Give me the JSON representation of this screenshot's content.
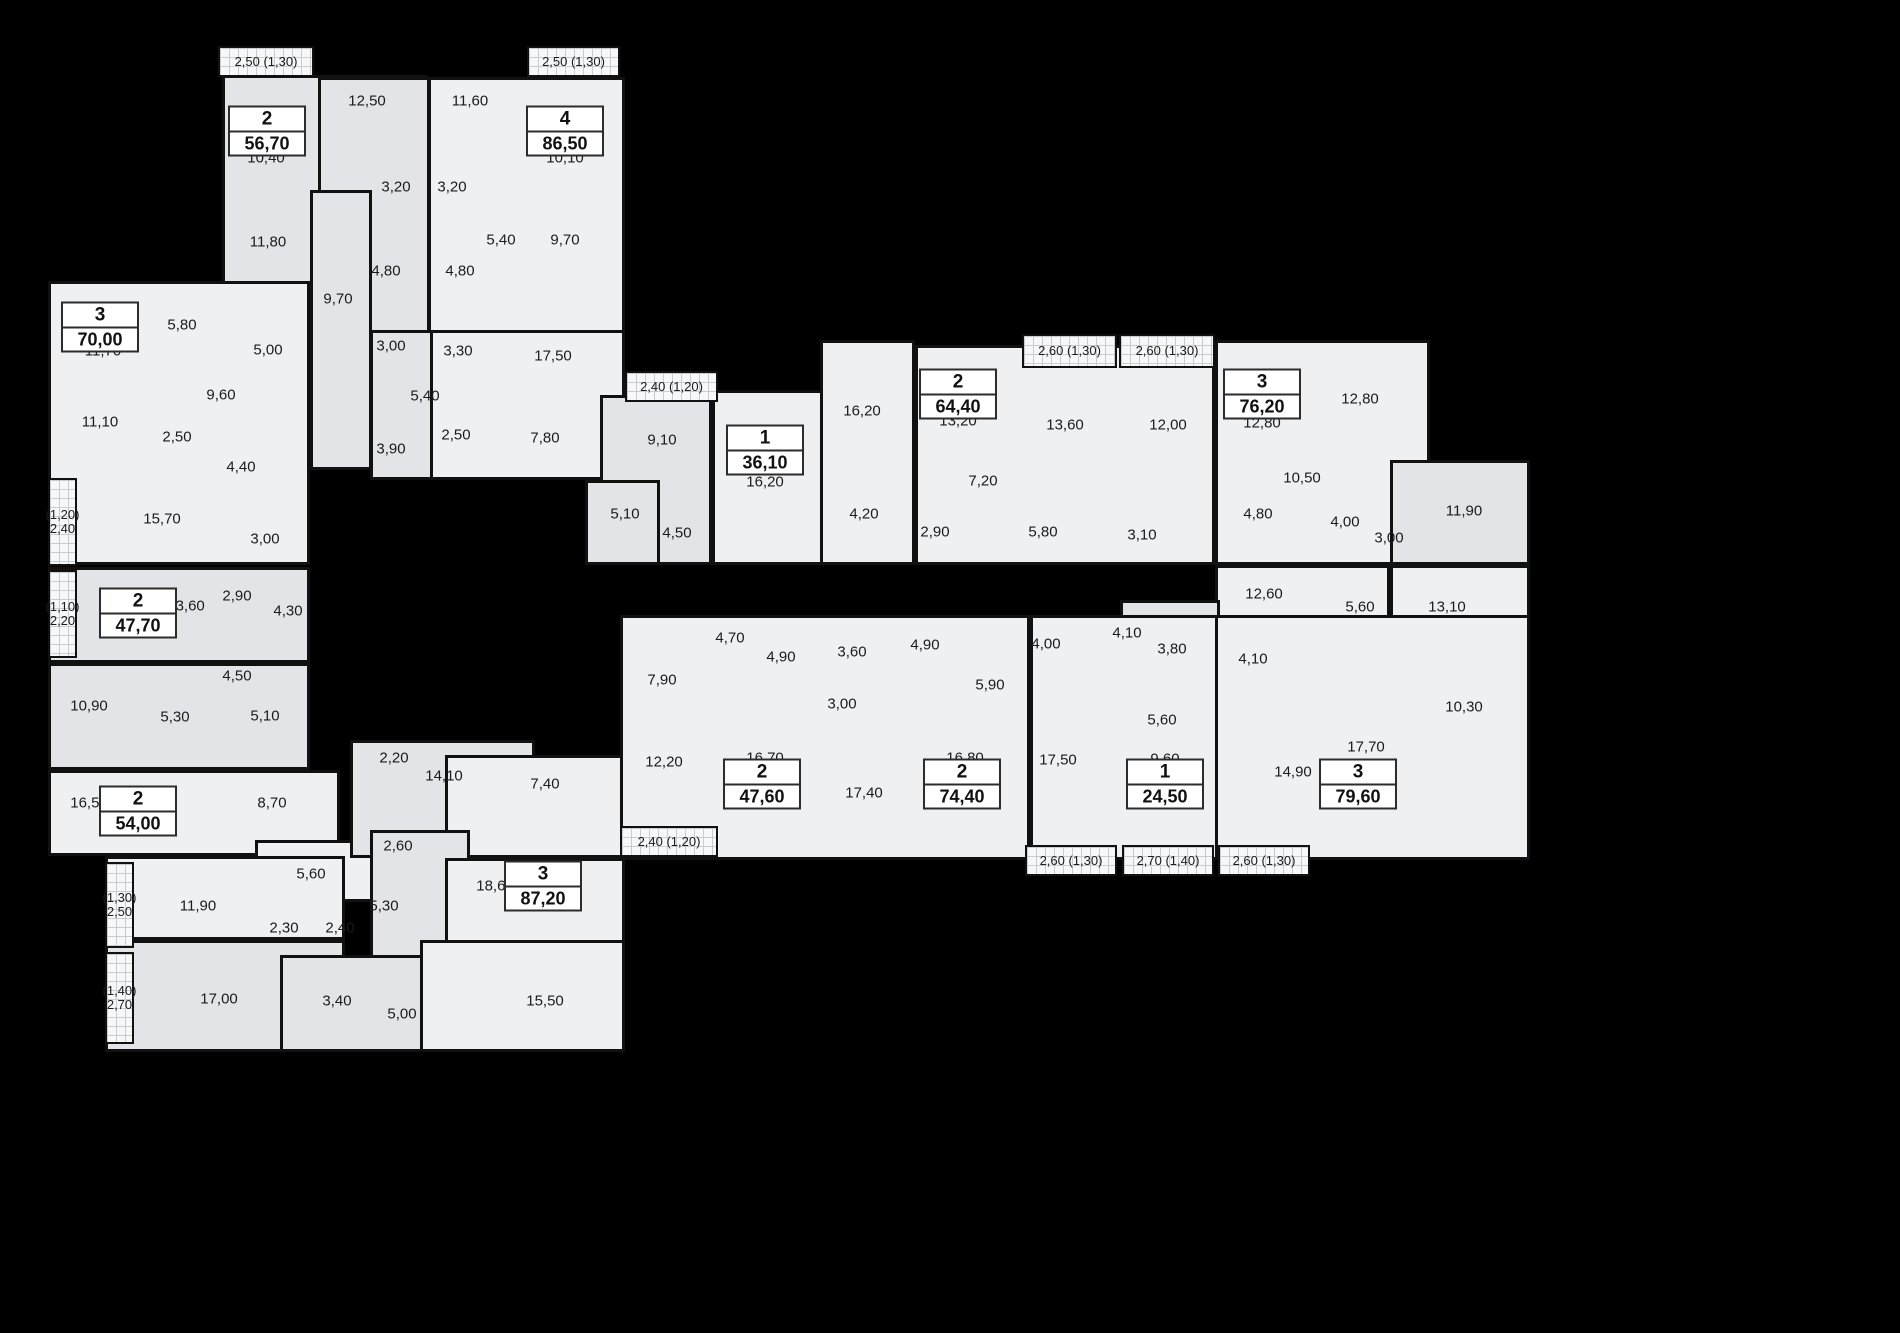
{
  "colors": {
    "background": "#000000",
    "room_light": "#eef0f2",
    "room_mid": "#e2e4e7",
    "wall": "#111111",
    "text": "#1b1b1b",
    "balcony_grid": "#c9ccd0"
  },
  "units": [
    {
      "rooms": "2",
      "area": "56,70",
      "x": 267,
      "y": 131
    },
    {
      "rooms": "4",
      "area": "86,50",
      "x": 565,
      "y": 131
    },
    {
      "rooms": "3",
      "area": "70,00",
      "x": 100,
      "y": 327
    },
    {
      "rooms": "2",
      "area": "47,70",
      "x": 138,
      "y": 613
    },
    {
      "rooms": "2",
      "area": "54,00",
      "x": 138,
      "y": 811
    },
    {
      "rooms": "3",
      "area": "87,20",
      "x": 543,
      "y": 886
    },
    {
      "rooms": "1",
      "area": "36,10",
      "x": 765,
      "y": 450
    },
    {
      "rooms": "2",
      "area": "64,40",
      "x": 958,
      "y": 394
    },
    {
      "rooms": "3",
      "area": "76,20",
      "x": 1262,
      "y": 394
    },
    {
      "rooms": "2",
      "area": "47,60",
      "x": 762,
      "y": 784
    },
    {
      "rooms": "2",
      "area": "74,40",
      "x": 962,
      "y": 784
    },
    {
      "rooms": "1",
      "area": "24,50",
      "x": 1165,
      "y": 784
    },
    {
      "rooms": "3",
      "area": "79,60",
      "x": 1358,
      "y": 784
    }
  ],
  "room_labels": [
    {
      "t": "12,50",
      "x": 367,
      "y": 101
    },
    {
      "t": "11,60",
      "x": 470,
      "y": 101
    },
    {
      "t": "10,40",
      "x": 266,
      "y": 158
    },
    {
      "t": "10,10",
      "x": 565,
      "y": 158
    },
    {
      "t": "3,20",
      "x": 396,
      "y": 187
    },
    {
      "t": "3,20",
      "x": 452,
      "y": 187
    },
    {
      "t": "11,80",
      "x": 268,
      "y": 242
    },
    {
      "t": "5,40",
      "x": 501,
      "y": 240
    },
    {
      "t": "9,70",
      "x": 565,
      "y": 240
    },
    {
      "t": "4,80",
      "x": 386,
      "y": 271
    },
    {
      "t": "4,80",
      "x": 460,
      "y": 271
    },
    {
      "t": "9,70",
      "x": 338,
      "y": 299
    },
    {
      "t": "3,00",
      "x": 391,
      "y": 346
    },
    {
      "t": "3,30",
      "x": 458,
      "y": 351
    },
    {
      "t": "17,50",
      "x": 553,
      "y": 356
    },
    {
      "t": "5,40",
      "x": 425,
      "y": 396
    },
    {
      "t": "2,50",
      "x": 456,
      "y": 435
    },
    {
      "t": "3,90",
      "x": 391,
      "y": 449
    },
    {
      "t": "7,80",
      "x": 545,
      "y": 438
    },
    {
      "t": "5,80",
      "x": 182,
      "y": 325
    },
    {
      "t": "11,70",
      "x": 103,
      "y": 351
    },
    {
      "t": "5,00",
      "x": 268,
      "y": 350
    },
    {
      "t": "9,60",
      "x": 221,
      "y": 395
    },
    {
      "t": "11,10",
      "x": 100,
      "y": 422
    },
    {
      "t": "2,50",
      "x": 177,
      "y": 437
    },
    {
      "t": "4,40",
      "x": 241,
      "y": 467
    },
    {
      "t": "15,70",
      "x": 162,
      "y": 519
    },
    {
      "t": "3,00",
      "x": 265,
      "y": 539
    },
    {
      "t": "2,90",
      "x": 237,
      "y": 596
    },
    {
      "t": "13,60",
      "x": 186,
      "y": 606
    },
    {
      "t": "4,30",
      "x": 288,
      "y": 611
    },
    {
      "t": "4,50",
      "x": 237,
      "y": 676
    },
    {
      "t": "10,90",
      "x": 89,
      "y": 706
    },
    {
      "t": "5,30",
      "x": 175,
      "y": 717
    },
    {
      "t": "5,10",
      "x": 265,
      "y": 716
    },
    {
      "t": "16,50",
      "x": 89,
      "y": 803
    },
    {
      "t": "8,70",
      "x": 272,
      "y": 803
    },
    {
      "t": "2,20",
      "x": 394,
      "y": 758
    },
    {
      "t": "14,10",
      "x": 444,
      "y": 776
    },
    {
      "t": "7,40",
      "x": 545,
      "y": 784
    },
    {
      "t": "2,60",
      "x": 398,
      "y": 846
    },
    {
      "t": "5,60",
      "x": 311,
      "y": 874
    },
    {
      "t": "11,90",
      "x": 198,
      "y": 906
    },
    {
      "t": "5,30",
      "x": 384,
      "y": 906
    },
    {
      "t": "18,60",
      "x": 495,
      "y": 886
    },
    {
      "t": "2,30",
      "x": 284,
      "y": 928
    },
    {
      "t": "2,40",
      "x": 340,
      "y": 928
    },
    {
      "t": "17,00",
      "x": 219,
      "y": 999
    },
    {
      "t": "3,40",
      "x": 337,
      "y": 1001
    },
    {
      "t": "5,00",
      "x": 402,
      "y": 1014
    },
    {
      "t": "15,50",
      "x": 545,
      "y": 1001
    },
    {
      "t": "9,10",
      "x": 662,
      "y": 440
    },
    {
      "t": "16,20",
      "x": 765,
      "y": 482
    },
    {
      "t": "5,10",
      "x": 625,
      "y": 514
    },
    {
      "t": "4,50",
      "x": 677,
      "y": 533
    },
    {
      "t": "16,20",
      "x": 862,
      "y": 411
    },
    {
      "t": "13,20",
      "x": 958,
      "y": 421
    },
    {
      "t": "13,60",
      "x": 1065,
      "y": 425
    },
    {
      "t": "12,00",
      "x": 1168,
      "y": 425
    },
    {
      "t": "7,20",
      "x": 983,
      "y": 481
    },
    {
      "t": "4,20",
      "x": 864,
      "y": 514
    },
    {
      "t": "2,90",
      "x": 935,
      "y": 532
    },
    {
      "t": "5,80",
      "x": 1043,
      "y": 532
    },
    {
      "t": "3,10",
      "x": 1142,
      "y": 535
    },
    {
      "t": "12,80",
      "x": 1262,
      "y": 423
    },
    {
      "t": "12,80",
      "x": 1360,
      "y": 399
    },
    {
      "t": "10,50",
      "x": 1302,
      "y": 478
    },
    {
      "t": "4,80",
      "x": 1258,
      "y": 514
    },
    {
      "t": "4,00",
      "x": 1345,
      "y": 522
    },
    {
      "t": "3,00",
      "x": 1389,
      "y": 538
    },
    {
      "t": "11,90",
      "x": 1464,
      "y": 511
    },
    {
      "t": "12,60",
      "x": 1264,
      "y": 594
    },
    {
      "t": "5,60",
      "x": 1360,
      "y": 607
    },
    {
      "t": "13,10",
      "x": 1447,
      "y": 607
    },
    {
      "t": "4,10",
      "x": 1127,
      "y": 633
    },
    {
      "t": "3,80",
      "x": 1172,
      "y": 649
    },
    {
      "t": "4,10",
      "x": 1253,
      "y": 659
    },
    {
      "t": "10,30",
      "x": 1464,
      "y": 707
    },
    {
      "t": "5,60",
      "x": 1162,
      "y": 720
    },
    {
      "t": "9,60",
      "x": 1165,
      "y": 759
    },
    {
      "t": "14,90",
      "x": 1293,
      "y": 772
    },
    {
      "t": "17,70",
      "x": 1366,
      "y": 747
    },
    {
      "t": "4,70",
      "x": 730,
      "y": 638
    },
    {
      "t": "4,90",
      "x": 781,
      "y": 657
    },
    {
      "t": "3,60",
      "x": 852,
      "y": 652
    },
    {
      "t": "4,90",
      "x": 925,
      "y": 645
    },
    {
      "t": "7,90",
      "x": 662,
      "y": 680
    },
    {
      "t": "3,00",
      "x": 842,
      "y": 704
    },
    {
      "t": "4,00",
      "x": 1046,
      "y": 644
    },
    {
      "t": "5,90",
      "x": 990,
      "y": 685
    },
    {
      "t": "12,20",
      "x": 664,
      "y": 762
    },
    {
      "t": "16,70",
      "x": 765,
      "y": 758
    },
    {
      "t": "17,40",
      "x": 864,
      "y": 793
    },
    {
      "t": "16,80",
      "x": 965,
      "y": 758
    },
    {
      "t": "17,50",
      "x": 1058,
      "y": 760
    }
  ],
  "balconies": [
    {
      "lines": [
        "2,50 (1,30)"
      ],
      "x": 218,
      "y": 46,
      "w": 96,
      "h": 31
    },
    {
      "lines": [
        "2,50 (1,30)"
      ],
      "x": 527,
      "y": 46,
      "w": 93,
      "h": 31
    },
    {
      "lines": [
        "2,40 (1,20)"
      ],
      "x": 625,
      "y": 371,
      "w": 93,
      "h": 31
    },
    {
      "lines": [
        "2,60 (1,30)"
      ],
      "x": 1022,
      "y": 334,
      "w": 95,
      "h": 34
    },
    {
      "lines": [
        "2,60 (1,30)"
      ],
      "x": 1119,
      "y": 334,
      "w": 96,
      "h": 34
    },
    {
      "lines": [
        "(1,20)",
        "2,40"
      ],
      "x": 48,
      "y": 478,
      "w": 29,
      "h": 88
    },
    {
      "lines": [
        "(1,10)",
        "2,20"
      ],
      "x": 48,
      "y": 570,
      "w": 29,
      "h": 88
    },
    {
      "lines": [
        "(1,30)",
        "2,50"
      ],
      "x": 105,
      "y": 862,
      "w": 29,
      "h": 86
    },
    {
      "lines": [
        "(1,40)",
        "2,70"
      ],
      "x": 105,
      "y": 952,
      "w": 29,
      "h": 92
    },
    {
      "lines": [
        "2,40 (1,20)"
      ],
      "x": 620,
      "y": 826,
      "w": 98,
      "h": 31
    },
    {
      "lines": [
        "2,60 (1,30)"
      ],
      "x": 1025,
      "y": 845,
      "w": 92,
      "h": 31
    },
    {
      "lines": [
        "2,70 (1,40)"
      ],
      "x": 1122,
      "y": 845,
      "w": 92,
      "h": 31
    },
    {
      "lines": [
        "2,60 (1,30)"
      ],
      "x": 1218,
      "y": 845,
      "w": 92,
      "h": 31
    }
  ],
  "blocks": [
    {
      "x": 222,
      "y": 75,
      "w": 206,
      "h": 272,
      "s": "b"
    },
    {
      "x": 318,
      "y": 77,
      "w": 112,
      "h": 270,
      "s": "b"
    },
    {
      "x": 428,
      "y": 77,
      "w": 197,
      "h": 313,
      "s": "a"
    },
    {
      "x": 310,
      "y": 190,
      "w": 62,
      "h": 280,
      "s": "b"
    },
    {
      "x": 370,
      "y": 330,
      "w": 100,
      "h": 150,
      "s": "b"
    },
    {
      "x": 430,
      "y": 330,
      "w": 195,
      "h": 150,
      "s": "a"
    },
    {
      "x": 48,
      "y": 281,
      "w": 262,
      "h": 284,
      "s": "a"
    },
    {
      "x": 48,
      "y": 567,
      "w": 262,
      "h": 96,
      "s": "b"
    },
    {
      "x": 48,
      "y": 663,
      "w": 262,
      "h": 107,
      "s": "b"
    },
    {
      "x": 48,
      "y": 770,
      "w": 292,
      "h": 86,
      "s": "a"
    },
    {
      "x": 255,
      "y": 840,
      "w": 120,
      "h": 62,
      "s": "a"
    },
    {
      "x": 105,
      "y": 856,
      "w": 240,
      "h": 84,
      "s": "a"
    },
    {
      "x": 105,
      "y": 940,
      "w": 240,
      "h": 112,
      "s": "b"
    },
    {
      "x": 280,
      "y": 955,
      "w": 175,
      "h": 97,
      "s": "b"
    },
    {
      "x": 350,
      "y": 740,
      "w": 185,
      "h": 118,
      "s": "b"
    },
    {
      "x": 445,
      "y": 755,
      "w": 180,
      "h": 103,
      "s": "a"
    },
    {
      "x": 370,
      "y": 830,
      "w": 100,
      "h": 128,
      "s": "b"
    },
    {
      "x": 445,
      "y": 858,
      "w": 180,
      "h": 96,
      "s": "a"
    },
    {
      "x": 420,
      "y": 940,
      "w": 205,
      "h": 112,
      "s": "a"
    },
    {
      "x": 600,
      "y": 395,
      "w": 112,
      "h": 170,
      "s": "b"
    },
    {
      "x": 585,
      "y": 480,
      "w": 75,
      "h": 85,
      "s": "b"
    },
    {
      "x": 712,
      "y": 390,
      "w": 118,
      "h": 175,
      "s": "a"
    },
    {
      "x": 820,
      "y": 340,
      "w": 95,
      "h": 225,
      "s": "a"
    },
    {
      "x": 915,
      "y": 345,
      "w": 300,
      "h": 220,
      "s": "a"
    },
    {
      "x": 1215,
      "y": 340,
      "w": 215,
      "h": 225,
      "s": "a"
    },
    {
      "x": 1390,
      "y": 460,
      "w": 140,
      "h": 105,
      "s": "b"
    },
    {
      "x": 1215,
      "y": 565,
      "w": 175,
      "h": 210,
      "s": "a"
    },
    {
      "x": 1390,
      "y": 565,
      "w": 140,
      "h": 210,
      "s": "a"
    },
    {
      "x": 1120,
      "y": 600,
      "w": 100,
      "h": 175,
      "s": "b"
    },
    {
      "x": 620,
      "y": 615,
      "w": 410,
      "h": 245,
      "s": "a"
    },
    {
      "x": 1030,
      "y": 615,
      "w": 190,
      "h": 245,
      "s": "a"
    },
    {
      "x": 1215,
      "y": 615,
      "w": 315,
      "h": 245,
      "s": "a"
    }
  ]
}
